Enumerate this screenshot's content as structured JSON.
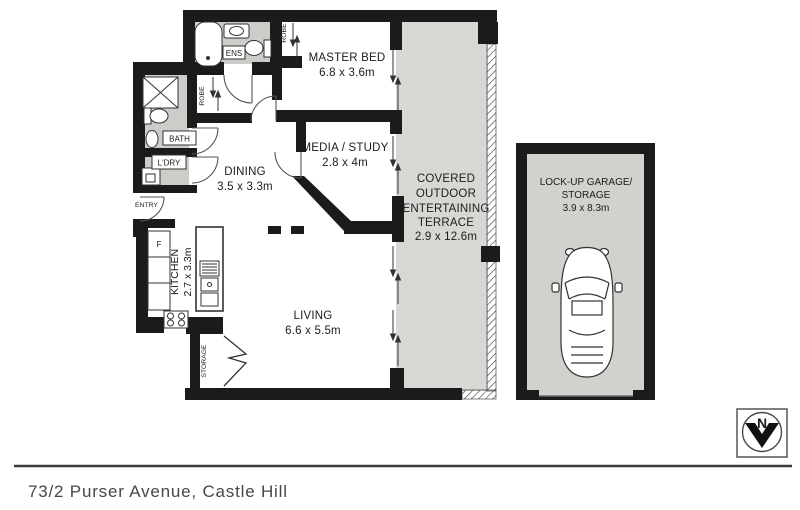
{
  "address": "73/2 Purser Avenue, Castle Hill",
  "compass": {
    "north_label": "N"
  },
  "colors": {
    "wall": "#1b1b1b",
    "wet_area_floor": "#cbcdc9",
    "terrace_floor": "#d7d8d4",
    "garage_floor": "#d0d2ce",
    "text": "#1c1c1c",
    "address_text": "#474747"
  },
  "rooms": {
    "master_bed": {
      "name": "MASTER BED",
      "dims": "6.8 x 3.6m"
    },
    "media_study": {
      "name": "MEDIA / STUDY",
      "dims": "2.8 x 4m"
    },
    "dining": {
      "name": "DINING",
      "dims": "3.5 x 3.3m"
    },
    "kitchen": {
      "name": "KITCHEN",
      "dims": "2.7 x 3.3m"
    },
    "living": {
      "name": "LIVING",
      "dims": "6.6 x 5.5m"
    },
    "terrace": {
      "line1": "COVERED",
      "line2": "OUTDOOR",
      "line3": "ENTERTAINING",
      "line4": "TERRACE",
      "dims": "2.9 x 12.6m"
    },
    "garage": {
      "line1": "LOCK-UP GARAGE/",
      "line2": "STORAGE",
      "dims": "3.9 x 8.3m"
    }
  },
  "labels": {
    "ensuite": "ENS",
    "bathroom": "BATH",
    "laundry": "L'DRY",
    "entry": "ENTRY",
    "robe": "ROBE",
    "storage": "STORAGE",
    "fridge": "F"
  }
}
